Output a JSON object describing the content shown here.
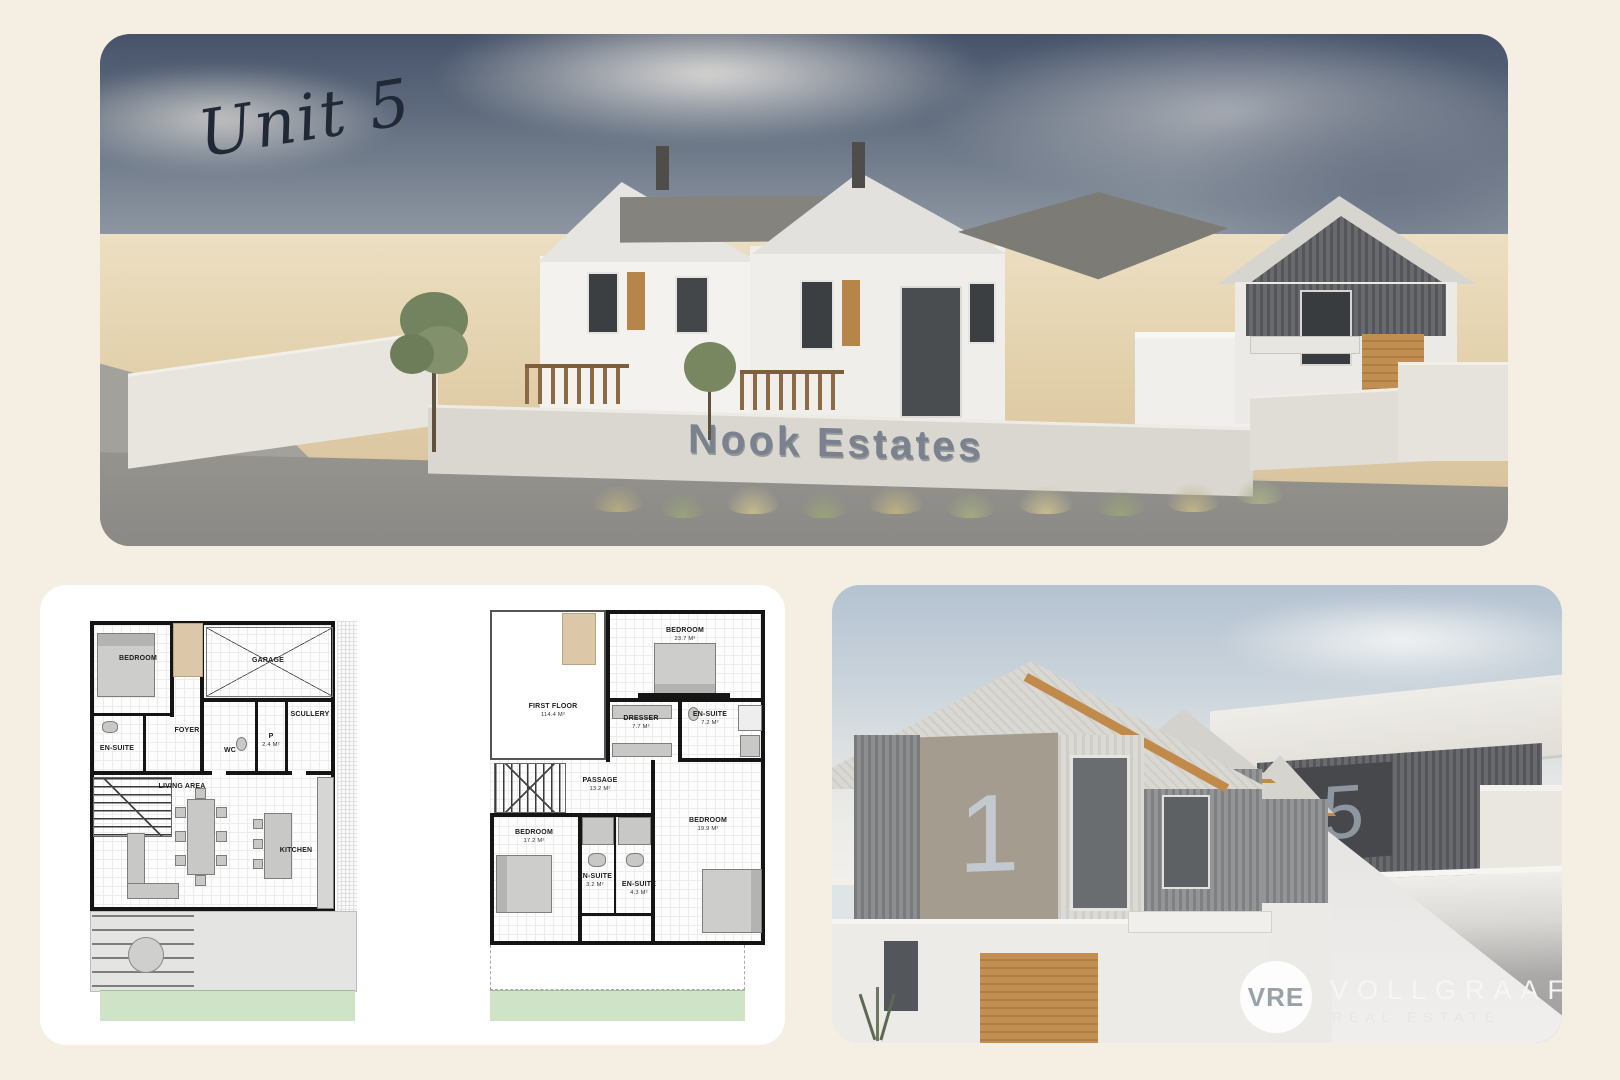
{
  "page": {
    "background_color": "#f4eee3"
  },
  "hero_render": {
    "handwritten_label": "Unit 5",
    "estate_sign_text": "Nook Estates"
  },
  "floor_plans": {
    "ground_floor": {
      "rooms": {
        "bedroom": "BEDROOM",
        "garage": "GARAGE",
        "foyer": "FOYER",
        "ensuite": "EN-SUITE",
        "wc": "WC",
        "pantry": "P",
        "pantry_area": "2.4 m²",
        "scullery": "SCULLERY",
        "living_area": "LIVING AREA",
        "kitchen": "KITCHEN"
      }
    },
    "first_floor": {
      "title": "FIRST FLOOR",
      "title_area": "114.4 m²",
      "rooms": {
        "bedroom_main": "BEDROOM",
        "bedroom_main_area": "23.7 m²",
        "dresser": "DRESSER",
        "dresser_area": "7.7 m²",
        "ensuite_main": "EN-SUITE",
        "ensuite_main_area": "7.2 m²",
        "passage": "PASSAGE",
        "passage_area": "13.2 m²",
        "bedroom_left": "BEDROOM",
        "bedroom_left_area": "17.2 m²",
        "ensuite_left": "EN-SUITE",
        "ensuite_left_area": "3.2 m²",
        "ensuite_right": "EN-SUITE",
        "ensuite_right_area": "4.3 m²",
        "bedroom_right": "BEDROOM",
        "bedroom_right_area": "19.9 m²"
      }
    }
  },
  "street_render": {
    "unit_number_left": "1",
    "unit_number_right": "5"
  },
  "brand": {
    "monogram": "VRE",
    "name": "VOLLGRAAFF",
    "tagline": "REAL ESTATE"
  },
  "colors": {
    "accent_wood": "#c28f52",
    "sign_gray": "#79828e",
    "plan_lawn_green": "#cfe4c6"
  }
}
